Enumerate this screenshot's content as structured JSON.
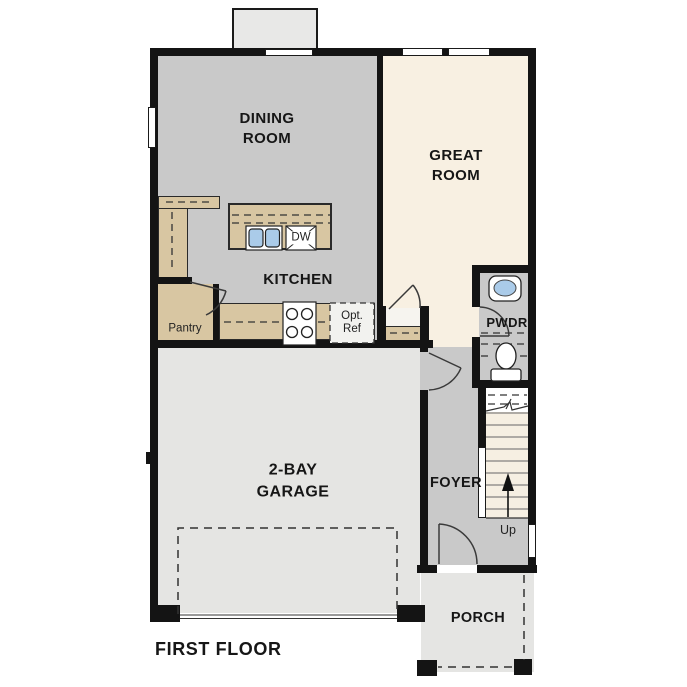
{
  "title": "FIRST FLOOR",
  "colors": {
    "wall": "#141414",
    "floor_gray": "#c9c9c9",
    "floor_cream": "#f8f0e2",
    "floor_light": "#e5e5e3",
    "counter_tan": "#d8c6a2",
    "sink_blue": "#aacbe9",
    "fixture_white": "#ffffff"
  },
  "rooms": {
    "dining": {
      "label": "DINING\nROOM"
    },
    "great": {
      "label": "GREAT\nROOM"
    },
    "kitchen": {
      "label": "KITCHEN"
    },
    "garage": {
      "label": "2-BAY\nGARAGE"
    },
    "foyer": {
      "label": "FOYER"
    },
    "pwdr": {
      "label": "PWDR"
    },
    "porch": {
      "label": "PORCH"
    },
    "pantry": {
      "label": "Pantry"
    }
  },
  "fixtures": {
    "dishwasher": {
      "label": "DW"
    },
    "opt_ref": {
      "label": "Opt.\nRef"
    },
    "stairs_up": {
      "label": "Up"
    }
  }
}
